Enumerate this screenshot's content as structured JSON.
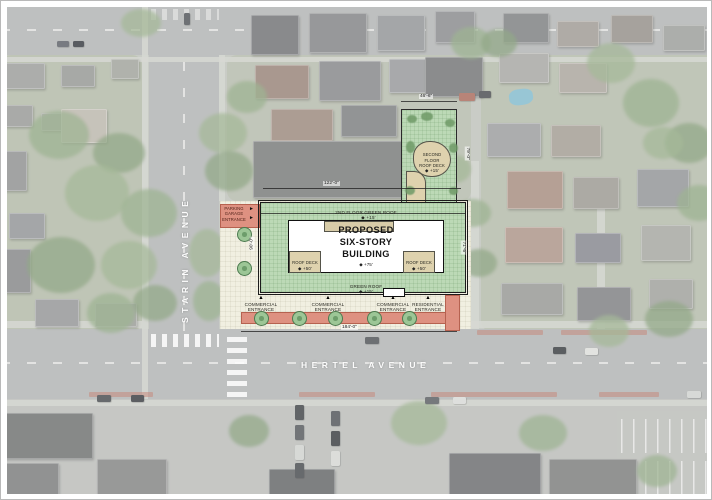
{
  "streets": {
    "starin": "STARIN AVENUE",
    "hertel": "HERTEL AVENUE"
  },
  "icons": {
    "entrance_marker": "▲",
    "garage_arrow": "►",
    "elev_diamond": "◆"
  },
  "plan": {
    "parking_garage": {
      "label": "PARKING\nGARAGE\nENTRANCE"
    },
    "green_roof_band": {
      "label": "2ND FLOOR GREEN ROOF",
      "elev": "◆ +15'"
    },
    "building": {
      "title": "PROPOSED\nSIX-STORY\nBUILDING",
      "elev": "◆ +75'"
    },
    "roof_deck_left": {
      "label": "ROOF DECK",
      "elev": "◆ +50'"
    },
    "roof_deck_right": {
      "label": "ROOF DECK",
      "elev": "◆ +50'"
    },
    "green_roof": {
      "label": "GREEN ROOF",
      "elev": "◆ +15'"
    },
    "second_floor_roof_deck": {
      "label": "SECOND\nFLOOR\nROOF DECK",
      "elev": "◆ +15'"
    },
    "entrances": [
      {
        "label": "COMMERCIAL\nENTRANCE"
      },
      {
        "label": "COMMERCIAL\nENTRANCE"
      },
      {
        "label": "COMMERCIAL\nENTRANCE"
      },
      {
        "label": "RESIDENTIAL\nENTRANCE"
      }
    ],
    "dimensions": {
      "north": "122'-0\"",
      "northeast": "46'-6\"",
      "east_upper": "79'-0\"",
      "west": "90'-0\"",
      "east": "71'-6\"",
      "south": "184'-0\""
    }
  },
  "colors": {
    "plan_green": "#bcd9b6",
    "plan_cream": "#f1efe1",
    "entrance_red": "#de9181",
    "deck_tan": "#ded2ae",
    "street_text": "#ffffff"
  }
}
